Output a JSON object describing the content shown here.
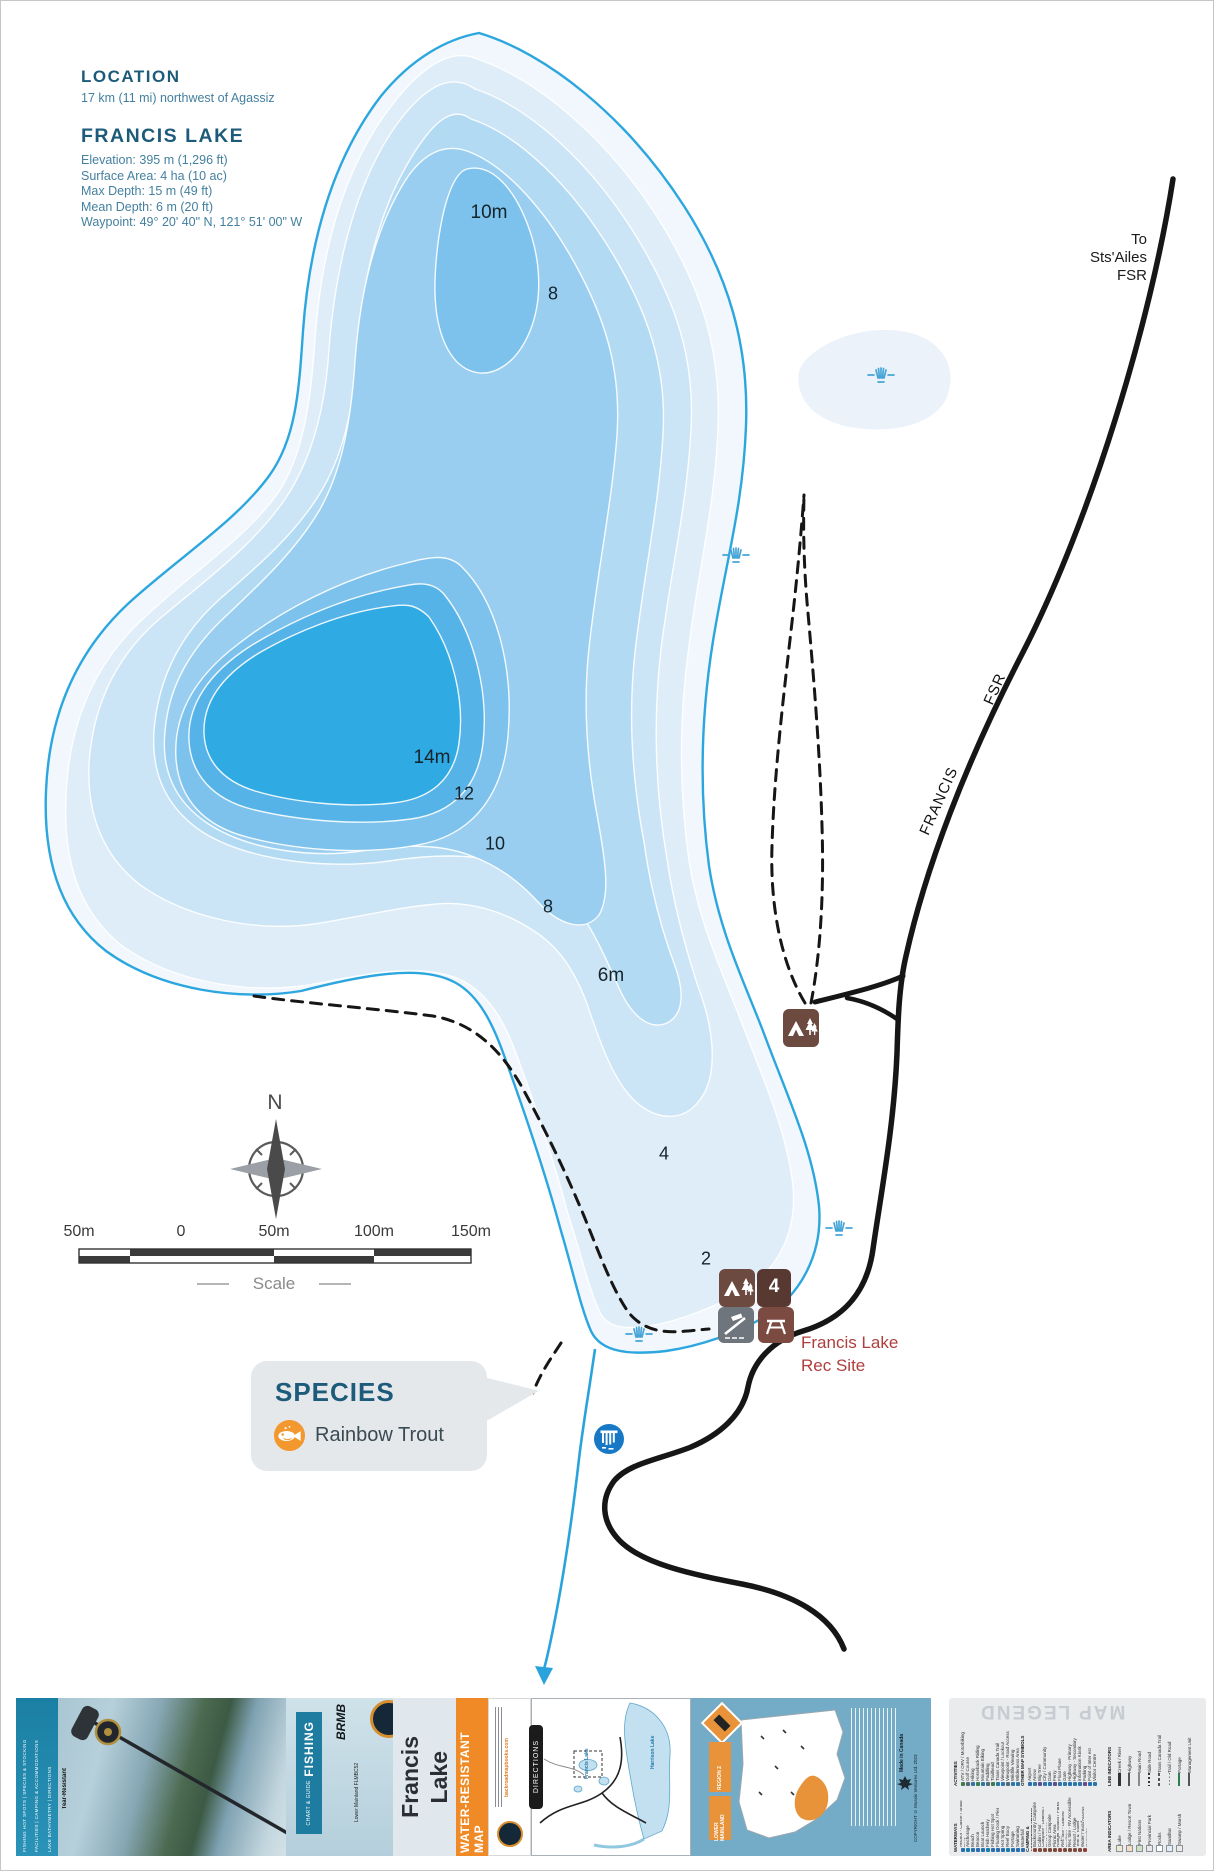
{
  "page": {
    "bg": "#ffffff",
    "border": "#c6c6c6"
  },
  "header": {
    "location_title": "LOCATION",
    "location_text": "17 km (11 mi) northwest of Agassiz",
    "lake_title": "FRANCIS LAKE",
    "stats": [
      "Elevation: 395 m (1,296 ft)",
      "Surface Area: 4 ha (10 ac)",
      "Max Depth: 15 m (49 ft)",
      "Mean Depth: 6 m (20 ft)",
      "Waypoint: 49° 20' 40\" N, 121° 51' 00\" W"
    ]
  },
  "map": {
    "to_road_label": {
      "line1": "To",
      "line2": "Sts'Ailes",
      "line3": "FSR"
    },
    "road_name": {
      "part1": "FRANCIS",
      "part2": "FSR"
    },
    "depth_labels": [
      "10m",
      "8",
      "14m",
      "12",
      "10",
      "8",
      "6m",
      "4",
      "2"
    ],
    "rec_site_label": {
      "line1": "Francis Lake",
      "line2": "Rec Site"
    },
    "campsite_capacity": "4",
    "compass": {
      "north": "N"
    },
    "scale": {
      "ticks": [
        "50m",
        "0",
        "50m",
        "100m",
        "150m"
      ],
      "caption": "Scale"
    },
    "species": {
      "title": "SPECIES",
      "items": [
        "Rainbow Trout"
      ]
    },
    "colors": {
      "shoreline": "#2ca6de",
      "depth_bands": [
        "#f1f7fc",
        "#deedf8",
        "#cbe4f6",
        "#b2daf3",
        "#99cef0",
        "#7cc2ec",
        "#55b3e7",
        "#2faae3"
      ],
      "road": "#161616",
      "creek": "#2aa3dc",
      "rec_site_text": "#af3e3c",
      "marsh": "#46a5d6"
    }
  },
  "strip": {
    "cover": {
      "edge_features": [
        "FISHING HOT SPOTS | SPECIES & STOCKING",
        "FACILITIES | CAMPING & ACCOMMODATIONS",
        "LAKE BATHYMETRY | DIRECTIONS"
      ],
      "tear_label": "Tear-Resistant",
      "brand": "BRMB",
      "banner_title": "FISHING",
      "banner_subtitle": "CHART & GUIDE",
      "series_code": "Lower Mainland FLMBC52",
      "map_title": {
        "line1": "Francis",
        "line2": "Lake"
      }
    },
    "water_resistant_label": "WATER-RESISTANT MAP",
    "publisher": {
      "website": "backroadmapbooks.com"
    },
    "directions": {
      "tab": "DIRECTIONS",
      "labels": [
        "Harrison Lake",
        "Francis Lake"
      ]
    },
    "region": {
      "badge_line1": "REGION 2",
      "badge_line2": "LOWER MAINLAND",
      "made_in": "Made in Canada",
      "copyright": "COPYRIGHT © Mussio Ventures Ltd. 2023"
    },
    "legend": {
      "title": "MAP LEGEND",
      "groups": [
        {
          "name": "ACTIVITIES",
          "items": [
            "ATV / ORV / Motorbiking",
            "Golf Course",
            "Hiking",
            "Horseback Riding",
            "Mountain Biking",
            "Paddling",
            "Trailhead",
            "Trans Canada Trail",
            "Viewpoint / Lookout",
            "Viewpoint - Road Access",
            "Wildlife Viewing",
            "Wilderness Area"
          ]
        },
        {
          "name": "OTHER MAP SYMBOLS",
          "items": [
            "Airport",
            "Arrow",
            "Big Tree",
            "City / Community",
            "Dam",
            "Ferry",
            "Float Plane",
            "Gate",
            "Highway - Primary",
            "Highway - Secondary",
            "Information Kiosk",
            "Parking",
            "Point of Inter est",
            "Visitor Centre"
          ]
        },
        {
          "name": "WATERWAYS",
          "items": [
            "Anchor - Canoe / Small Boat",
            "Anchorage",
            "Beach",
            "Beacon",
            "Boat Launch",
            "Fish Hatchery",
            "Fishing Hot Spot",
            "Floating Dock / Pier",
            "Hot Spring",
            "Reef Buoy",
            "Portage",
            "Swimming",
            "Waterfall"
          ]
        },
        {
          "name": "CAMPING & ACCOMMODATIONS",
          "items": [
            "Backcountry Campsite",
            "Cabin / Hut",
            "Campsite - Limited / Boat Access",
            "Group Campsite",
            "Picnic Area",
            "Ranger Station / Parks Cabin",
            "Rec Site - Limited Facilities",
            "Rec Site - RV Accessible",
            "Resort / Lodge",
            "Tent & Trailer Campground",
            "Water / Boat Access Campsite"
          ]
        },
        {
          "name": "LINE INDICATORS",
          "items": [
            "Creek / River",
            "Highway",
            "Main Road",
            "Side Road",
            "Trans Canada Trail",
            "Trail / Old Road",
            "Portage",
            "Management Unit"
          ]
        },
        {
          "name": "AREA INDICATORS",
          "items": [
            "Lake",
            "Lodge / Resort Town",
            "First Nations",
            "Provincial Park",
            "Rocks",
            "Sandbar",
            "Swamp / Marsh"
          ]
        }
      ]
    }
  }
}
